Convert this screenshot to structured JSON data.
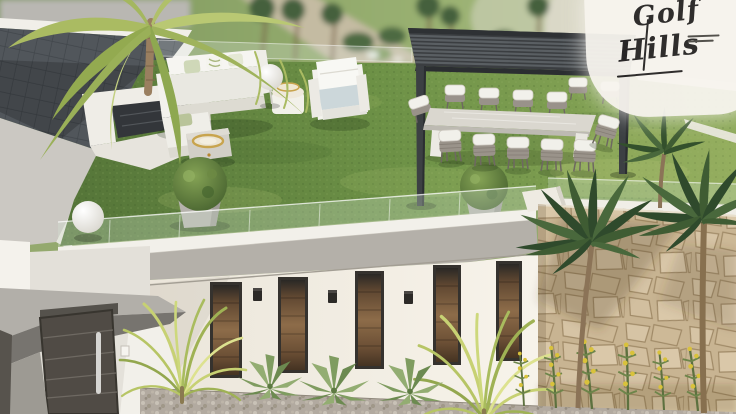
{
  "logo": {
    "word1": "Golf",
    "word2": "Hills",
    "tagline_lines": 2
  },
  "palette": {
    "grass_green": "#63833f",
    "grass_light": "#8fae60",
    "background_green": "#8aa468",
    "pergola_gray": "#3b3e41",
    "stone_beige": "#c8b492",
    "facade_white": "#f1ede5",
    "concrete_gray": "#b4b0a9",
    "tile_gray": "#51565b",
    "wood_brown": "#8a684a",
    "palm_yellow_green": "#aebc66",
    "palm_dark_green": "#33502c",
    "furniture_white": "#f3f2ed",
    "gold_accent": "#c8a44e",
    "door_gray": "#504b45",
    "gravel_gray": "#b2aaa0",
    "logo_ink": "#262424",
    "logo_bg": "#f8f5ef"
  }
}
